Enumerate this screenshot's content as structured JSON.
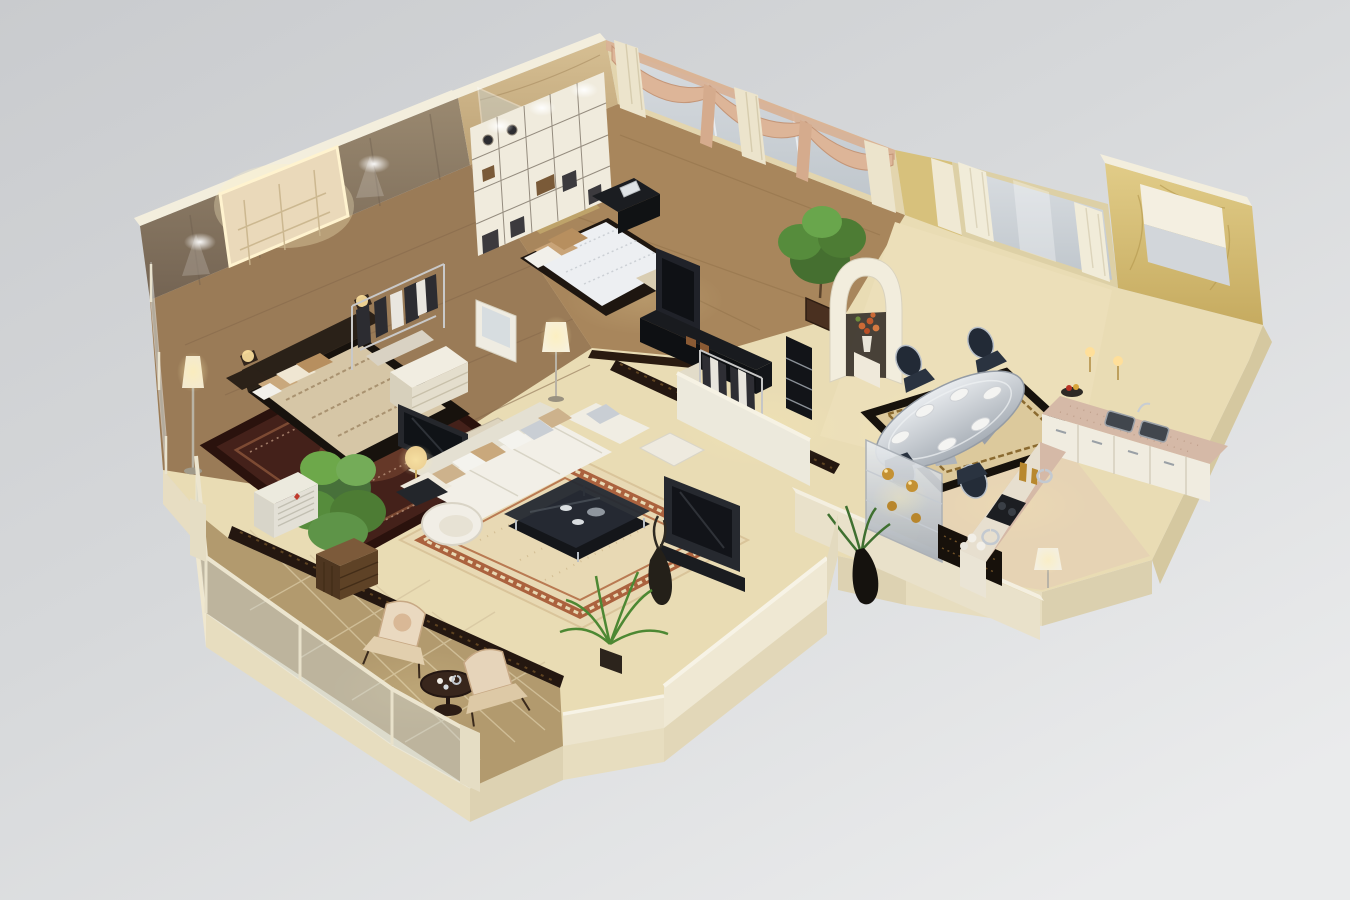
{
  "scene": {
    "title": "3D cutaway floor plan render of a furnished apartment",
    "view": "high-angle dollhouse cutaway, walls cut open, no visible text",
    "background": {
      "top_left": "#c9cbce",
      "bottom_right": "#e9eaeb"
    },
    "palette": {
      "slab_cream": "#e6dcbc",
      "slab_side": "#d9cda9",
      "wall_cap": "#f3eedd",
      "brown_feature_wall": "#8b7a63",
      "yellow_marble": "#d6bf7a",
      "tan_marble": "#cdb489",
      "wood_floor": "#9a7b57",
      "cream_marble_floor": "#e9dcb4",
      "balcony_tile": "#b29a6e",
      "red_oriental_rug": "#44211a",
      "greek_key_rug_border": "#a85c38",
      "sofa_white": "#efece2",
      "pillow_tan": "#c9a87c",
      "dark_furniture": "#1d2026",
      "silver": "#c3c9d0",
      "curtain_cream": "#ece4cc",
      "swag_peach": "#ddb598",
      "window_glass": "#ccd2d7",
      "counter_pink_marble": "#d5b9a7",
      "cabinet_white": "#f0ece0",
      "plant_green": "#568c3c",
      "gold_accent": "#c49133",
      "dark_inlay_marble": "#241710",
      "lamp_glow": "#ffeeb0"
    },
    "rooms": [
      {
        "id": "master-bedroom",
        "name": "master bedroom",
        "furniture": [
          "double bed with patterned duvet and pillows",
          "backlit ornate headboard panel",
          "two nightstand lamps",
          "floor lamp",
          "red oriental rug",
          "open clothes rack",
          "white drawer chest",
          "flat-screen TV",
          "vanity with mirror",
          "ceiling spotlights on brown feature wall",
          "glass balustrade"
        ]
      },
      {
        "id": "bathroom",
        "name": "shower room",
        "furniture": [
          "glass shower enclosure",
          "tan marble wall",
          "marble floor"
        ]
      },
      {
        "id": "second-bedroom",
        "name": "second bedroom",
        "furniture": [
          "wall-to-wall shelving unit with decor",
          "double bed with white duvet and tan pillows",
          "black desk with laptop",
          "flat-screen TV",
          "dark media console",
          "clothes rack",
          "swag curtains over windows",
          "potted plant"
        ]
      },
      {
        "id": "walk-in-closet",
        "name": "walk-in closet",
        "furniture": [
          "clothes racks",
          "folded garment shelves",
          "black display column",
          "arched niche with flower vase"
        ]
      },
      {
        "id": "living-room",
        "name": "living room",
        "furniture": [
          "white sectional sofa with cushions",
          "round lounge chair",
          "dark glass coffee table",
          "side table with gold lamp",
          "dark TV media wall",
          "second TV",
          "greek-key border rug",
          "palm plant",
          "ficus tree in wooden planter",
          "decorative floor vase"
        ]
      },
      {
        "id": "dining-room",
        "name": "dining room",
        "furniture": [
          "oval silver dining table with place settings",
          "four dark upholstered chairs",
          "bordered rug",
          "silver display sideboard with gold urns",
          "black marble console",
          "plant in black vase",
          "white table lamp",
          "white curtains on windows"
        ]
      },
      {
        "id": "kitchen",
        "name": "kitchen",
        "furniture": [
          "L-shaped counter with pink marble top",
          "white cabinet fronts",
          "double sink",
          "dark cooktop",
          "window with white roller shade",
          "yellow marble walls",
          "countertop bottles and dishes",
          "candle lights",
          "fruit bowl"
        ]
      },
      {
        "id": "balcony",
        "name": "balcony terrace",
        "furniture": [
          "glass railing with cream posts",
          "two floral armchairs",
          "round pedestal tea table",
          "diagonal stone tiles",
          "air-conditioner unit",
          "wooden planter"
        ]
      },
      {
        "id": "hallway",
        "name": "hallway",
        "furniture": [
          "cream marble floor with dark inlay borders",
          "standing lamp"
        ]
      }
    ]
  }
}
